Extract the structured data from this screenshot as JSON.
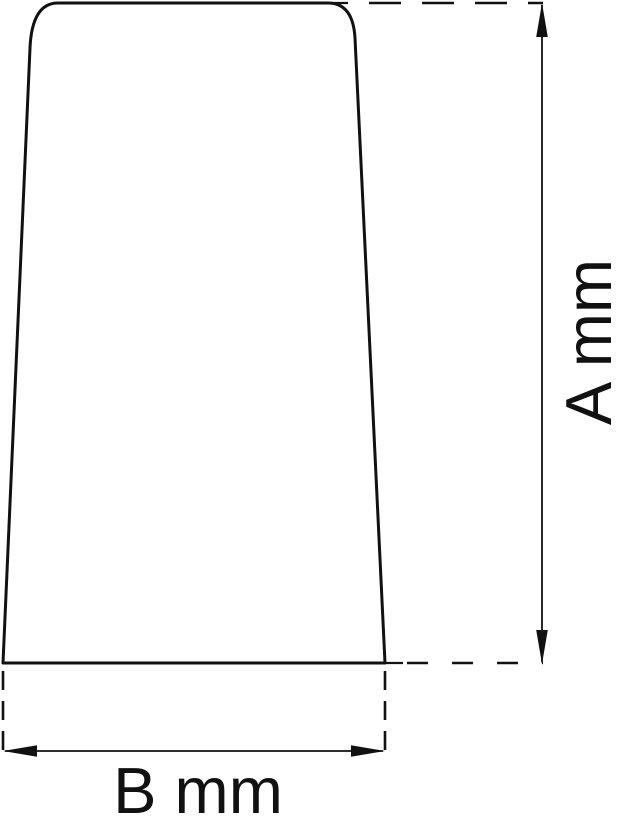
{
  "page": {
    "background_color": "#ffffff",
    "ink_color": "#111111"
  },
  "drawing": {
    "type": "technical-dimension-drawing",
    "object": {
      "shape": "tapered profile with rounded top corners, wider at base"
    },
    "dimension_a": {
      "label": "A mm",
      "orientation": "vertical",
      "measures": "object height"
    },
    "dimension_b": {
      "label": "B mm",
      "orientation": "horizontal",
      "measures": "object base width"
    }
  }
}
